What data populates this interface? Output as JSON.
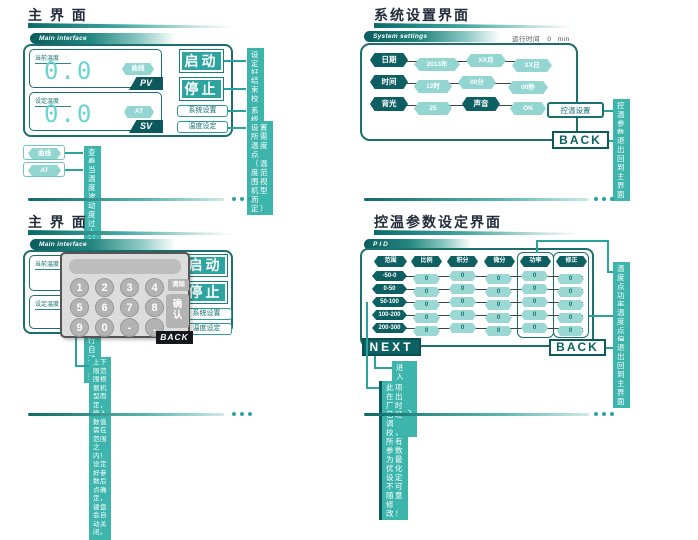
{
  "colors": {
    "teal_dark": "#0d5f61",
    "teal_mid": "#2da49f",
    "teal_annotation": "#3db5ac",
    "teal_light": "#93d6d1",
    "digit_cyan": "#68d4d6"
  },
  "panel_main": {
    "title": "主 界 面",
    "banner": "Main interface",
    "current_label": "当前温度",
    "current_value": "0.0",
    "curve_button": "曲线",
    "pv_tag": "PV",
    "set_label": "设定温度",
    "set_value": "0.0",
    "at_button": "AT",
    "sv_tag": "SV",
    "start_button": "启动",
    "stop_button": "停止",
    "system_button": "系统设置",
    "temp_button": "温度设定",
    "ann_start": "设定好温度后点启动\n键设备开始升温工作",
    "ann_stop": "结束校验或暂停工作\n是点停止键",
    "ann_system": "系统相关设置",
    "ann_temp": "设置所需温度点（温\n度范围视机型而定）",
    "legend_curve_button": "曲线",
    "legend_curve_desc": "查看记录及曲线",
    "legend_at_button": "AT",
    "legend_at_desc": "当温度波动度过大时启用该功能可由程序执行自动调整"
  },
  "panel_settings": {
    "title": "系统设置界面",
    "banner": "System settings",
    "runtime_label": "运行时间",
    "runtime_value": "0",
    "runtime_unit": "min",
    "date_label": "日期",
    "date_year": "2013年",
    "date_month": "XX月",
    "date_day": "XX日",
    "time_label": "时间",
    "time_hour": "12时",
    "time_min": "00分",
    "time_sec": "00秒",
    "backlight_label": "背光",
    "backlight_value": "25",
    "sound_label": "声音",
    "sound_value": "ON",
    "ctrl_button": "控温设置",
    "back_button": "BACK",
    "ann_ctrl": "控温参数设定\n点击进入",
    "ann_back": "退出回到主界面"
  },
  "panel_keypad": {
    "title": "主 界 面",
    "banner": "Main interface",
    "current_label": "当前温度",
    "set_label": "设定温度",
    "start_button": "启动",
    "stop_button": "停止",
    "system_button": "系统设置",
    "temp_button": "温度设定",
    "keys": [
      "1",
      "2",
      "3",
      "4",
      "5",
      "6",
      "7",
      "8",
      "9",
      "0",
      "-",
      "."
    ],
    "clear_button": "清除",
    "confirm_button": "确\n认",
    "back_button": "BACK",
    "note": "上下限范围根据机型而定，输入数值需在范围之内！\n设定好参数后点确定，键盘会自动关闭。"
  },
  "panel_pid": {
    "title": "控温参数设定界面",
    "banner": "PID",
    "headers": [
      "范围",
      "比例",
      "积分",
      "微分",
      "功率",
      "修正"
    ],
    "rows": [
      {
        "range": "-50-0",
        "values": [
          "0",
          "0",
          "0",
          "0",
          "0"
        ]
      },
      {
        "range": "0-50",
        "values": [
          "0",
          "0",
          "0",
          "0",
          "0"
        ]
      },
      {
        "range": "50-100",
        "values": [
          "0",
          "0",
          "0",
          "0",
          "0"
        ]
      },
      {
        "range": "100-200",
        "values": [
          "0",
          "0",
          "0",
          "0",
          "0"
        ]
      },
      {
        "range": "200-300",
        "values": [
          "0",
          "0",
          "0",
          "0",
          "0"
        ]
      }
    ],
    "next_button": "NEXT",
    "back_button": "BACK",
    "ann_power": "温度点功率\n设定",
    "ann_offset": "温度点偏差值\n修正",
    "ann_back": "退出回到主界面",
    "ann_next": "进入下一页PID设置",
    "note": "此项在出厂时已经调校，所有参数为最优化设定不可随意修改！"
  }
}
